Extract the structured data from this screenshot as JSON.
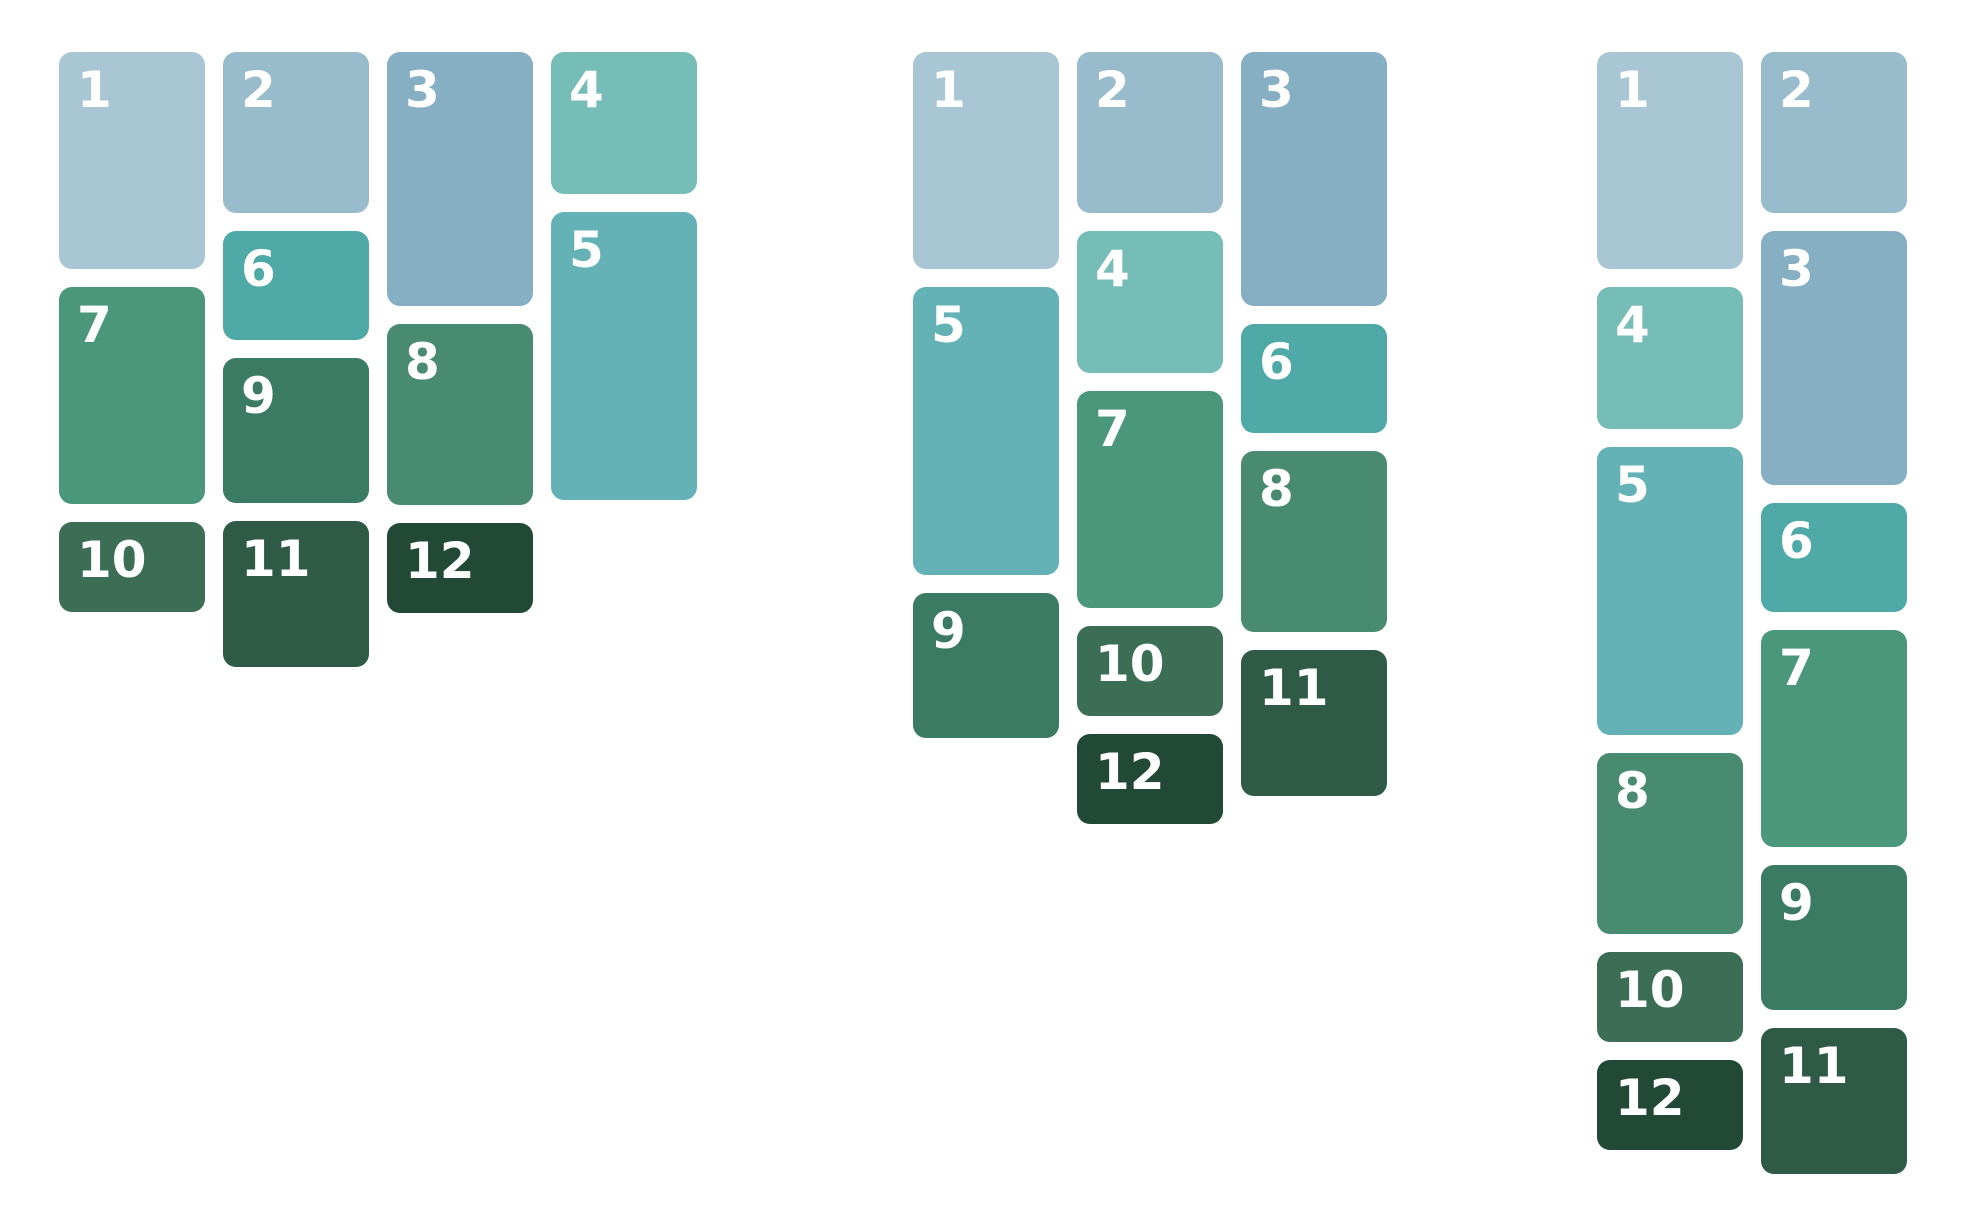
{
  "page": {
    "background_color": "#ffffff",
    "description": "Masonry layout demo: twelve numbered cards flowed into 4, 3 and 2 columns"
  },
  "layout": {
    "top": 52,
    "tile_width": 146,
    "gap": 18,
    "corner_radius": 13,
    "text_color": "#ffffff"
  },
  "tiles": [
    {
      "label": "1",
      "color": "#A9C6D5",
      "height": 217
    },
    {
      "label": "2",
      "color": "#98BCCB",
      "height": 161
    },
    {
      "label": "3",
      "color": "#87AFC4",
      "height": 254
    },
    {
      "label": "4",
      "color": "#76BCB7",
      "height": 142
    },
    {
      "label": "5",
      "color": "#64B2B5",
      "height": 288
    },
    {
      "label": "6",
      "color": "#4FA9A6",
      "height": 109
    },
    {
      "label": "7",
      "color": "#4A977C",
      "height": 217
    },
    {
      "label": "8",
      "color": "#488B71",
      "height": 181
    },
    {
      "label": "9",
      "color": "#3B7A63",
      "height": 145
    },
    {
      "label": "10",
      "color": "#3C6E56",
      "height": 90
    },
    {
      "label": "11",
      "color": "#2E5A46",
      "height": 146
    },
    {
      "label": "12",
      "color": "#224936",
      "height": 90
    }
  ],
  "groups": [
    {
      "name": "masonry-group-4col",
      "x": 59,
      "columns": [
        [
          1,
          7,
          10
        ],
        [
          2,
          6,
          9,
          11
        ],
        [
          3,
          8,
          12
        ],
        [
          4,
          5
        ]
      ]
    },
    {
      "name": "masonry-group-3col",
      "x": 913,
      "columns": [
        [
          1,
          5,
          9
        ],
        [
          2,
          4,
          7,
          10,
          12
        ],
        [
          3,
          6,
          8,
          11
        ]
      ]
    },
    {
      "name": "masonry-group-2col",
      "x": 1597,
      "columns": [
        [
          1,
          4,
          5,
          8,
          10,
          12
        ],
        [
          2,
          3,
          6,
          7,
          9,
          11
        ]
      ]
    }
  ]
}
